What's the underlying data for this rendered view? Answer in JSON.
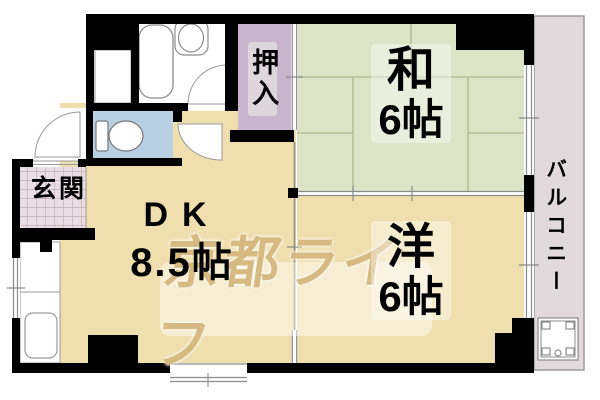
{
  "rooms": {
    "dk": {
      "label": "DK",
      "size": "8.5帖"
    },
    "washitsu": {
      "label": "和",
      "size": "6帖"
    },
    "youshitsu": {
      "label": "洋",
      "size": "6帖"
    },
    "oshiire": {
      "label": "押入"
    },
    "genkan": {
      "label": "玄関"
    },
    "balcony": {
      "label": "バルコニー"
    }
  },
  "watermark": {
    "text": "京都ライフ",
    "color": "#d6ba82"
  },
  "colors": {
    "room_tan": "#f0dfae",
    "tatami_green": "#dce3c6",
    "closet_lavender": "#c8b4cd",
    "toilet_blue": "#b9d0e2",
    "balcony_pink": "#e2d9dd",
    "genkan_tile": "#e9dee3",
    "wall_black": "#000000",
    "line_grey": "#8c8c8c",
    "watermark_tan": "#d6ba82"
  },
  "fixtures": [
    "bathtub",
    "wash-basin",
    "toilet",
    "kitchen-sink",
    "washing-machine-pan"
  ]
}
